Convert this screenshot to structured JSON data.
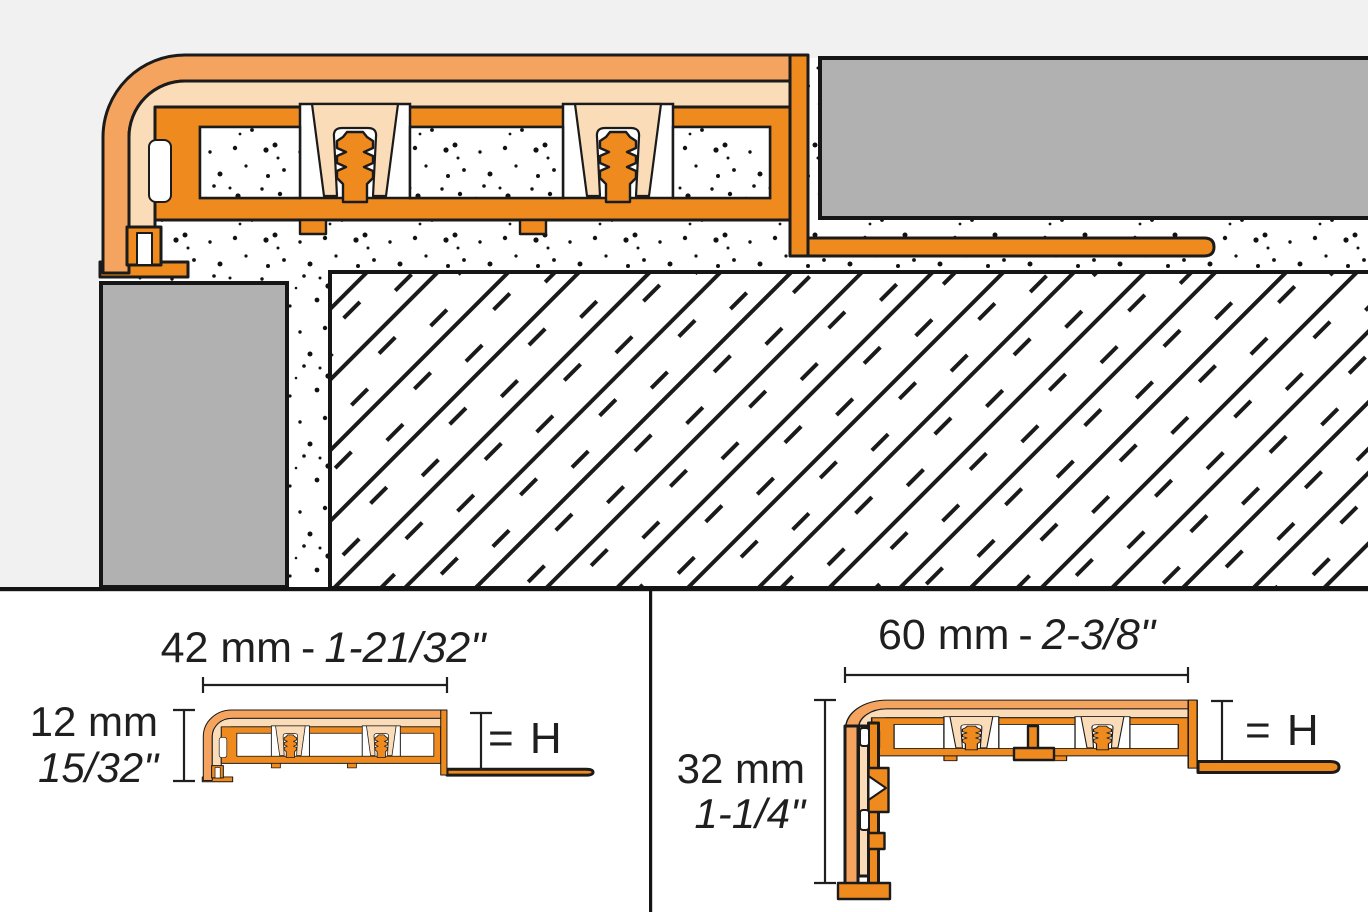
{
  "colors": {
    "profile_body_orange": "#EE8A1E",
    "profile_surface_orange": "#F4A45F",
    "profile_insert_peach": "#FBDCB8",
    "tile_gray": "#B1B1B1",
    "background_gray": "#F1F1F1",
    "panel_background": "#FFFFFF",
    "outline_black": "#1B1B1B"
  },
  "panels": {
    "left": {
      "width_metric": "42 mm",
      "separator": "-",
      "width_imperial": "1-21/32\"",
      "height_metric": "12 mm",
      "height_imperial": "15/32\"",
      "height_equals": "= H"
    },
    "right": {
      "width_metric": "60 mm",
      "separator": "-",
      "width_imperial": "2-3/8\"",
      "height_metric": "32 mm",
      "height_imperial": "1-1/4\"",
      "height_equals": "= H"
    }
  }
}
